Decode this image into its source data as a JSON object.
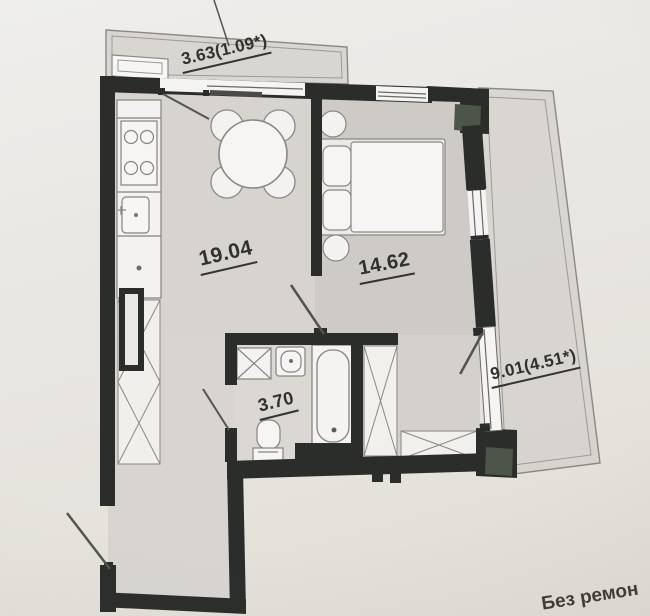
{
  "document": {
    "type": "apartment floor plan photo",
    "caption_bottom_right": "Без ремон"
  },
  "rooms": [
    {
      "name": "balcony-top",
      "area_label": "3.63(1.09*)"
    },
    {
      "name": "kitchen-living-room",
      "area_label": "19.04"
    },
    {
      "name": "bedroom",
      "area_label": "14.62"
    },
    {
      "name": "bathroom",
      "area_label": "3.70"
    },
    {
      "name": "balcony-right",
      "area_label": "9.01(4.51*)"
    }
  ],
  "colors": {
    "paper": "#e9e7e3",
    "wall": "#2b2d2b",
    "floor": "#d6d3cf",
    "balcony_fill": "#d2cfca",
    "corner_column": "#4d5449",
    "label_text": "#32302c"
  }
}
